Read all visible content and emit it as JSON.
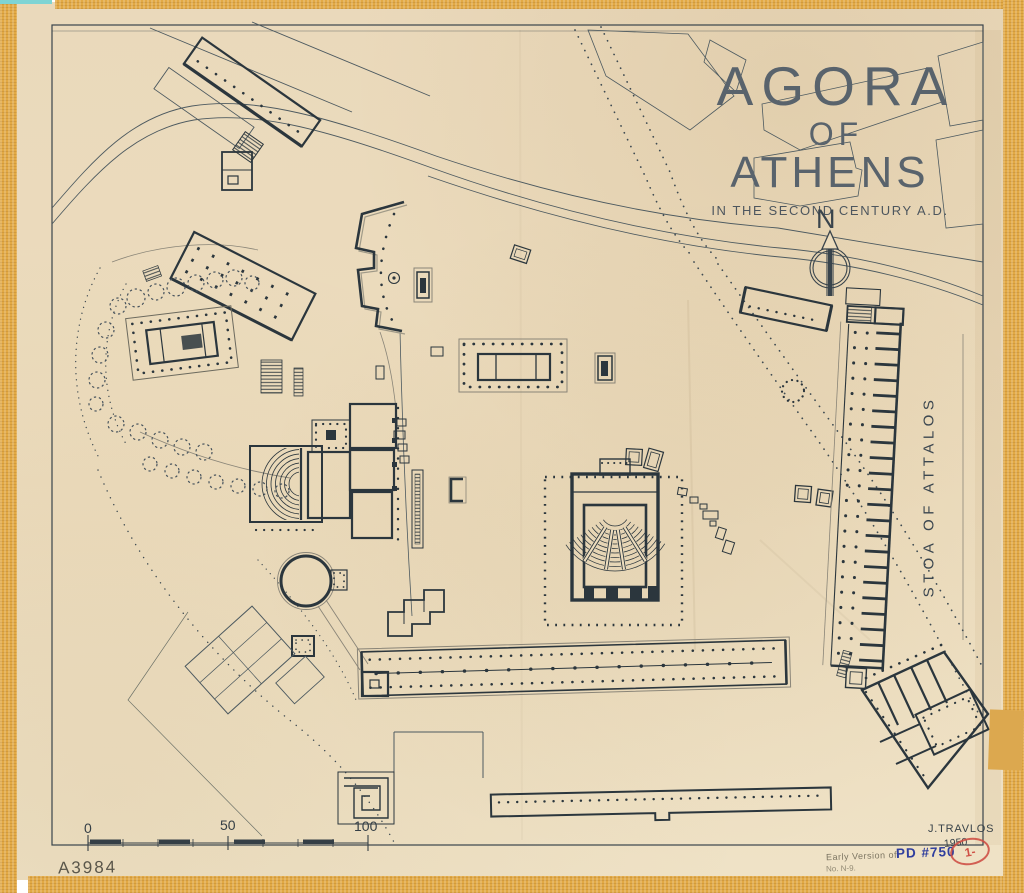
{
  "artwork": {
    "title_line1": "AGORA",
    "title_line2": "OF",
    "title_line3": "ATHENS",
    "subtitle": "IN THE SECOND CENTURY A.D.",
    "north_label": "N",
    "stoa_of_attalos_label": "STOA OF ATTALOS"
  },
  "scale_bar": {
    "start": "0",
    "middle": "50",
    "end": "100"
  },
  "inscriptions": {
    "negative_number": "A3984",
    "author": "J.TRAVLOS",
    "year": "1950",
    "pencil_note_line1": "Early Version of",
    "pencil_note_line2": "No. N-9.",
    "drawing_reference": "PD #750",
    "stamp_mark": "1-"
  },
  "colors": {
    "paper": "#ecdcbd",
    "ink": "#2b363d",
    "title_grey": "#59636c",
    "tape_orange": "#e2a944",
    "reference_blue": "#2f3e9e",
    "stamp_red": "#c9504a",
    "pencil_grey": "#5f5a48"
  }
}
